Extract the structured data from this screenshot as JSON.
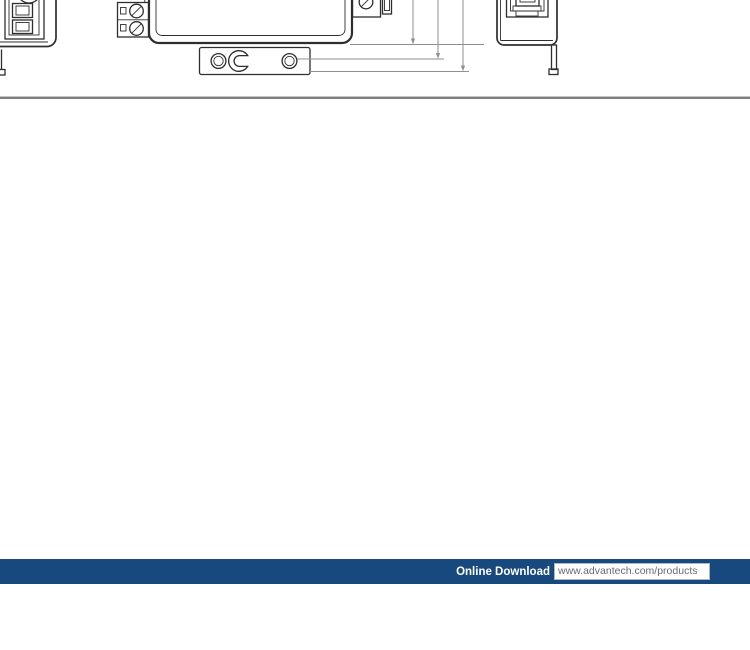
{
  "page": {
    "background_color": "#ffffff"
  },
  "figure": {
    "kind": "mechanical-dimension-drawing",
    "views": [
      {
        "name": "left-side-view"
      },
      {
        "name": "bottom-view-with-mounting-bracket-and-dimension-lines"
      },
      {
        "name": "right-side-view-with-din-rail-clip"
      }
    ]
  },
  "divider_color": "#7f7f7f",
  "footer": {
    "bar_color": "#17497E",
    "download_label": "Online Download",
    "download_url": "www.advantech.com/products",
    "label_color": "#ffffff",
    "url_text_color": "#6b6b6b"
  }
}
